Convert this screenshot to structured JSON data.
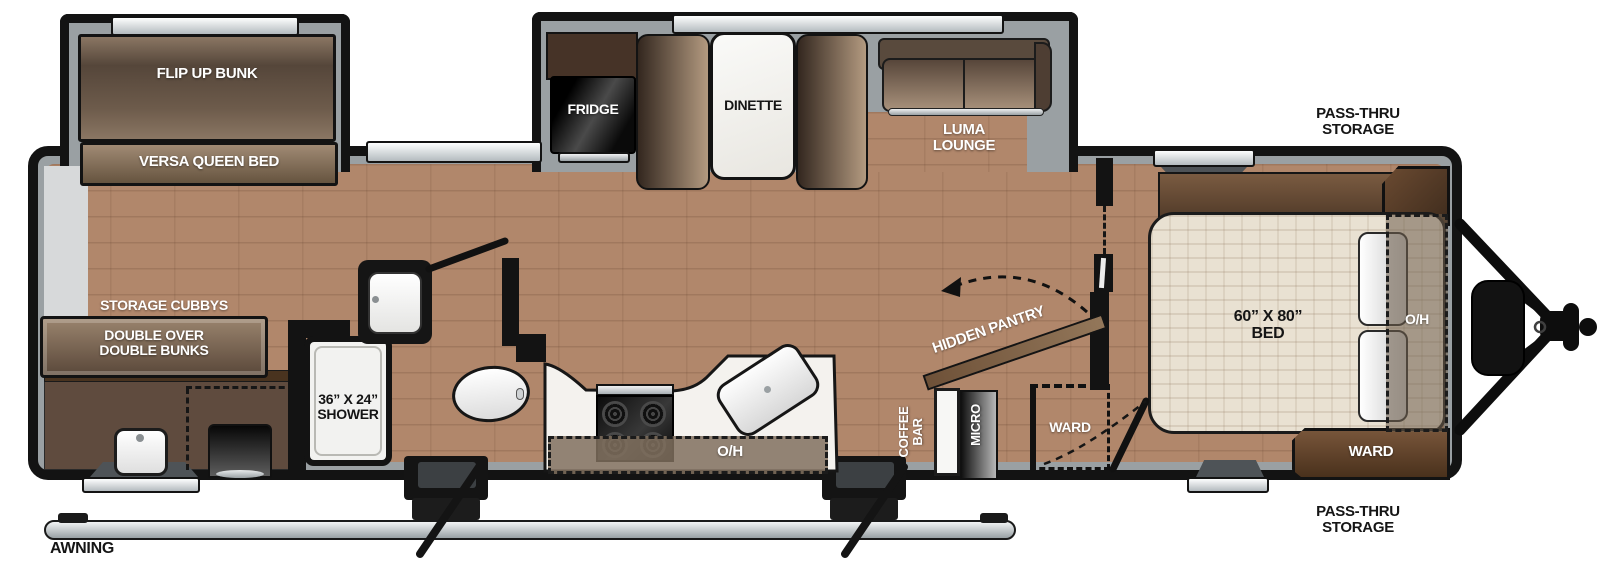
{
  "meta": {
    "type": "travel-trailer floorplan",
    "view": "top-down"
  },
  "colors": {
    "outline": "#131313",
    "wall_fill": "#9aa0a3",
    "floor_wood": "#b1876b",
    "furniture_brown": "#5f4b3e",
    "cabinet_brown": "#6d4a2e",
    "mattress_cream": "#e9e1d2",
    "counter_white": "#f4f2ee",
    "appliance_black": "#111111",
    "metal_silver": "#c9ced1"
  },
  "bunk_room": {
    "flip_up_bunk": "FLIP UP BUNK",
    "versa_queen_bed": "VERSA QUEEN BED",
    "storage_cubbys": "STORAGE CUBBYS",
    "double_bunks_line1": "DOUBLE OVER",
    "double_bunks_line2": "DOUBLE BUNKS"
  },
  "bathroom": {
    "shower_line1": "36” X 24”",
    "shower_line2": "SHOWER"
  },
  "galley": {
    "fridge": "FRIDGE",
    "dinette": "DINETTE",
    "luma_line1": "LUMA",
    "luma_line2": "LOUNGE",
    "overhead": "O/H",
    "coffee_line1": "COFFEE",
    "coffee_line2": "BAR",
    "micro": "MICRO",
    "hidden_pantry": "HIDDEN PANTRY",
    "ward": "WARD"
  },
  "bedroom": {
    "bed_line1": "60” X 80”",
    "bed_line2": "BED",
    "overhead": "O/H",
    "ward": "WARD"
  },
  "exterior": {
    "awning": "AWNING",
    "pass_thru_line1": "PASS-THRU",
    "pass_thru_line2": "STORAGE"
  }
}
